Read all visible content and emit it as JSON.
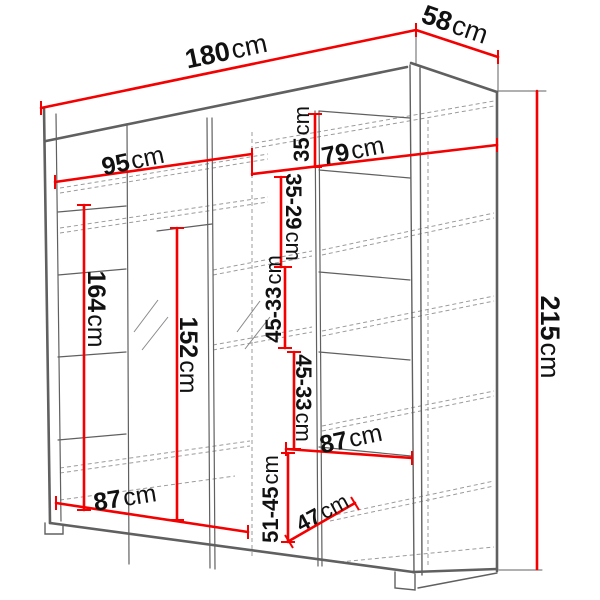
{
  "diagram": {
    "kind": "wardrobe dimension drawing",
    "unit": "cm",
    "colors": {
      "dimension_red": "#f40000",
      "cabinet_gray": "#606060",
      "hidden_gray": "#9b9b9b",
      "text_black": "#111111",
      "background": "#ffffff"
    },
    "dims": {
      "overall_width": {
        "value": "180",
        "unit": "cm"
      },
      "overall_depth": {
        "value": "58",
        "unit": "cm"
      },
      "overall_height": {
        "value": "215",
        "unit": "cm"
      },
      "top_left_width": {
        "value": "95",
        "unit": "cm"
      },
      "top_right_width": {
        "value": "79",
        "unit": "cm"
      },
      "top_shelf_height": {
        "value": "35",
        "unit": "cm"
      },
      "shelf_gap_upper": {
        "value": "35-29",
        "unit": "cm"
      },
      "shelf_gap_mid_upper": {
        "value": "45-33",
        "unit": "cm"
      },
      "shelf_gap_mid_lower": {
        "value": "45-33",
        "unit": "cm"
      },
      "shelf_gap_lower": {
        "value": "51-45",
        "unit": "cm"
      },
      "left_hanging_height": {
        "value": "164",
        "unit": "cm"
      },
      "center_hanging_height": {
        "value": "152",
        "unit": "cm"
      },
      "bottom_left_width": {
        "value": "87",
        "unit": "cm"
      },
      "bottom_right_width": {
        "value": "87",
        "unit": "cm"
      },
      "interior_depth": {
        "value": "47",
        "unit": "cm"
      }
    }
  }
}
